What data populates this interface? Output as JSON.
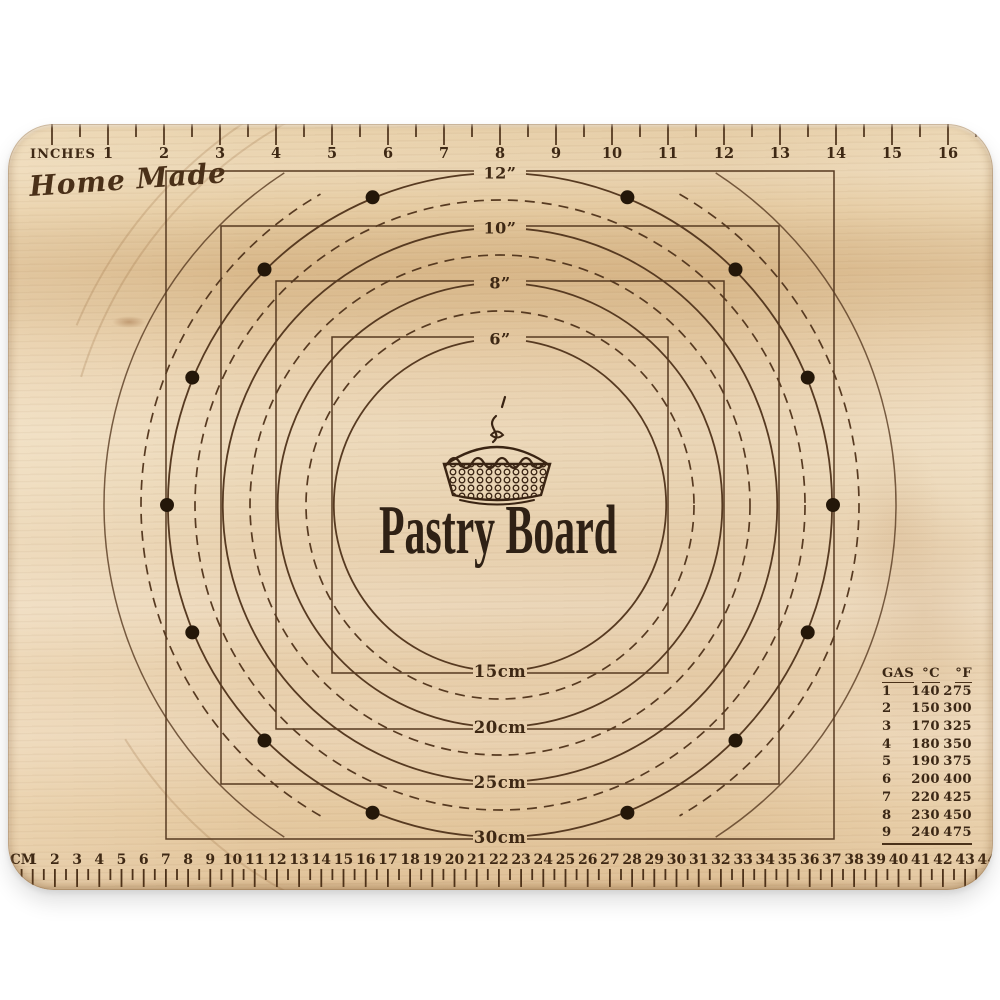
{
  "page": {
    "background": "#ffffff"
  },
  "board": {
    "brand": "Home Made",
    "title": "Pastry Board",
    "colors": {
      "wood_light": "#eedcbf",
      "wood_mid": "#e8d0ab",
      "wood_dark": "#d9b88a",
      "engraving": "#573a21",
      "dot": "#241709",
      "text": "#3e2814"
    }
  },
  "inch_ruler": {
    "label": "INCHES",
    "numbers": [
      1,
      2,
      3,
      4,
      5,
      6,
      7,
      8,
      9,
      10,
      11,
      12,
      13,
      14,
      15,
      16
    ]
  },
  "cm_ruler": {
    "label": "CM",
    "numbers": [
      1,
      2,
      3,
      4,
      5,
      6,
      7,
      8,
      9,
      10,
      11,
      12,
      13,
      14,
      15,
      16,
      17,
      18,
      19,
      20,
      21,
      22,
      23,
      24,
      25,
      26,
      27,
      28,
      29,
      30,
      31,
      32,
      33,
      34,
      35,
      36,
      37,
      38,
      39,
      40,
      41,
      42,
      43,
      44
    ]
  },
  "diagram": {
    "cx": 492,
    "cy": 381,
    "solid_circles": [
      {
        "r": 166,
        "inch_label": "6”",
        "cm_label": "15cm"
      },
      {
        "r": 222,
        "inch_label": "8”",
        "cm_label": "20cm"
      },
      {
        "r": 277,
        "inch_label": "10”",
        "cm_label": "25cm"
      },
      {
        "r": 332,
        "inch_label": "12”",
        "cm_label": "30cm"
      }
    ],
    "dashed_circles": [
      194,
      250,
      305
    ],
    "outer_dashed_circle": {
      "r": 359,
      "arcs": [
        [
          30,
          150
        ],
        [
          210,
          330
        ]
      ]
    },
    "outer_solid_circle": {
      "r": 396,
      "arcs": [
        [
          33,
          147
        ],
        [
          213,
          327
        ]
      ]
    },
    "grain_arcs": [
      {
        "r": 438,
        "arcs": [
          [
            287,
            341
          ]
        ]
      },
      {
        "r": 460,
        "arcs": [
          [
            293,
            335
          ]
        ]
      },
      {
        "r": 442,
        "arcs": [
          [
            197,
            238
          ]
        ]
      }
    ],
    "label_gap": 26,
    "square_extra": 2,
    "dot_ring": {
      "r": 333,
      "dot_radius": 7,
      "angles_deg": [
        22.5,
        45,
        67.5,
        90,
        112.5,
        135,
        157.5,
        202.5,
        225,
        247.5,
        270,
        292.5,
        315,
        337.5
      ]
    }
  },
  "oven_table": {
    "headers": [
      "GAS",
      "°C",
      "°F"
    ],
    "rows": [
      [
        "1",
        "140",
        "275"
      ],
      [
        "2",
        "150",
        "300"
      ],
      [
        "3",
        "170",
        "325"
      ],
      [
        "4",
        "180",
        "350"
      ],
      [
        "5",
        "190",
        "375"
      ],
      [
        "6",
        "200",
        "400"
      ],
      [
        "7",
        "220",
        "425"
      ],
      [
        "8",
        "230",
        "450"
      ],
      [
        "9",
        "240",
        "475"
      ]
    ]
  }
}
